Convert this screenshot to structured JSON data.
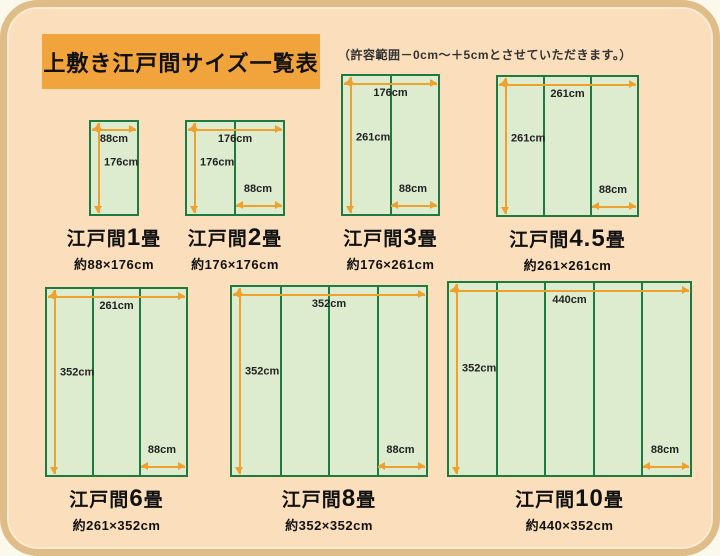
{
  "page": {
    "title": "上敷き江戸間サイズ一覧表",
    "note": "（許容範囲－0cm～＋5cmとさせていただきます。）"
  },
  "colors": {
    "page_background": "#fdf8ec",
    "board_background": "#fbdfbc",
    "board_border": "#dfbd89",
    "title_background": "#f2a43c",
    "mat_fill": "#ddeccf",
    "mat_border": "#1e7a3e",
    "arrow": "#f0a02c",
    "text": "#1f1f1f"
  },
  "mats": [
    {
      "name_prefix": "江戸間",
      "name_num": "1",
      "name_suffix": "畳",
      "size": "約88×176cm",
      "width_label": "88cm",
      "height_label": "176cm",
      "panel_width_label": null,
      "panels": 1,
      "dimensions_cm": {
        "width": 88,
        "height": 176
      },
      "box": {
        "x": 89,
        "y": 120,
        "w": 50,
        "h": 96
      }
    },
    {
      "name_prefix": "江戸間",
      "name_num": "2",
      "name_suffix": "畳",
      "size": "約176×176cm",
      "width_label": "176cm",
      "height_label": "176cm",
      "panel_width_label": "88cm",
      "panels": 2,
      "dimensions_cm": {
        "width": 176,
        "height": 176
      },
      "box": {
        "x": 185,
        "y": 120,
        "w": 100,
        "h": 96
      }
    },
    {
      "name_prefix": "江戸間",
      "name_num": "3",
      "name_suffix": "畳",
      "size": "約176×261cm",
      "width_label": "176cm",
      "height_label": "261cm",
      "panel_width_label": "88cm",
      "panels": 2,
      "dimensions_cm": {
        "width": 176,
        "height": 261
      },
      "box": {
        "x": 341,
        "y": 74,
        "w": 99,
        "h": 142
      }
    },
    {
      "name_prefix": "江戸間",
      "name_num": "4.5",
      "name_suffix": "畳",
      "size": "約261×261cm",
      "width_label": "261cm",
      "height_label": "261cm",
      "panel_width_label": "88cm",
      "panels": 3,
      "dimensions_cm": {
        "width": 261,
        "height": 261
      },
      "box": {
        "x": 496,
        "y": 75,
        "w": 143,
        "h": 142
      }
    },
    {
      "name_prefix": "江戸間",
      "name_num": "6",
      "name_suffix": "畳",
      "size": "約261×352cm",
      "width_label": "261cm",
      "height_label": "352cm",
      "panel_width_label": "88cm",
      "panels": 3,
      "dimensions_cm": {
        "width": 261,
        "height": 352
      },
      "box": {
        "x": 45,
        "y": 287,
        "w": 143,
        "h": 190
      }
    },
    {
      "name_prefix": "江戸間",
      "name_num": "8",
      "name_suffix": "畳",
      "size": "約352×352cm",
      "width_label": "352cm",
      "height_label": "352cm",
      "panel_width_label": "88cm",
      "panels": 4,
      "dimensions_cm": {
        "width": 352,
        "height": 352
      },
      "box": {
        "x": 230,
        "y": 285,
        "w": 198,
        "h": 192
      }
    },
    {
      "name_prefix": "江戸間",
      "name_num": "10",
      "name_suffix": "畳",
      "size": "約440×352cm",
      "width_label": "440cm",
      "height_label": "352cm",
      "panel_width_label": "88cm",
      "panels": 5,
      "dimensions_cm": {
        "width": 440,
        "height": 352
      },
      "box": {
        "x": 447,
        "y": 281,
        "w": 245,
        "h": 196
      }
    }
  ]
}
